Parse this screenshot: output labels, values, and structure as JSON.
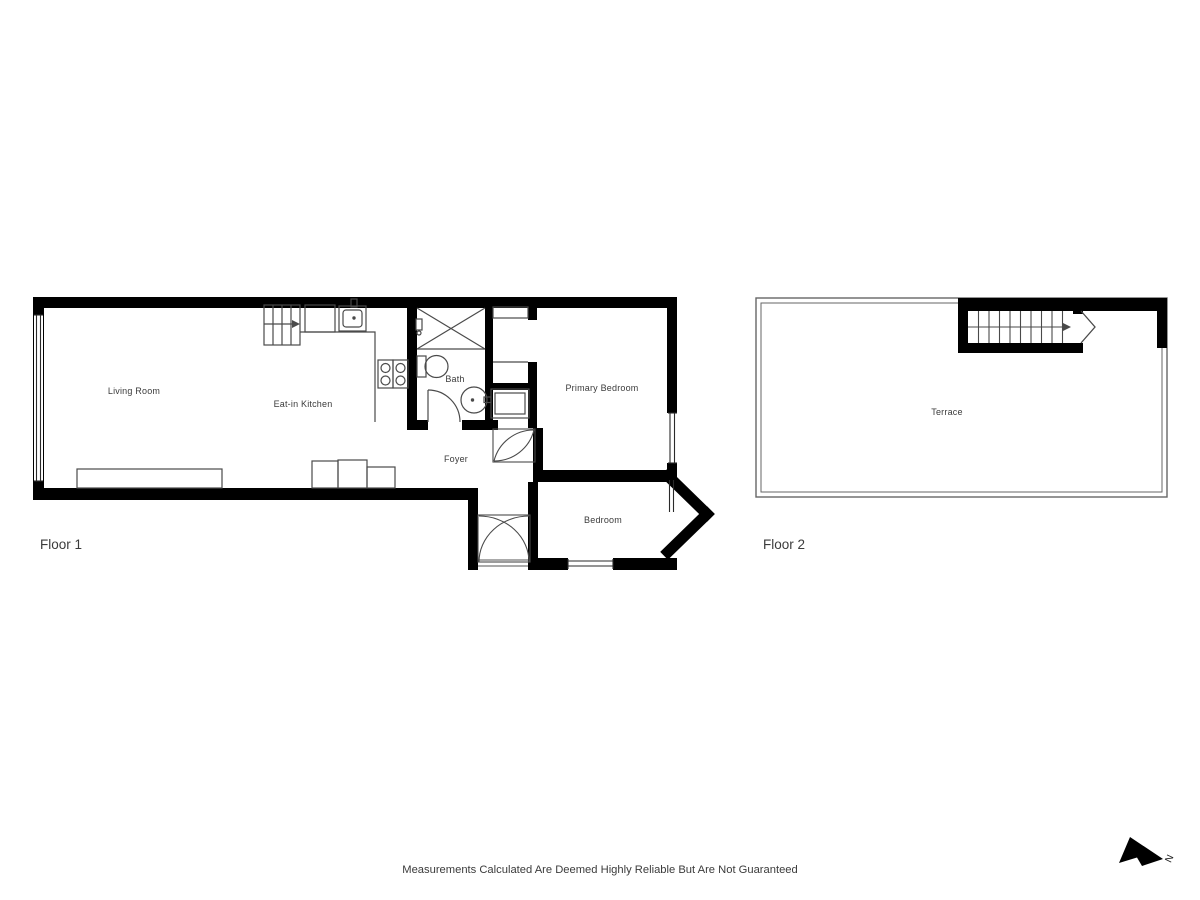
{
  "disclaimer": "Measurements Calculated Are Deemed Highly Reliable But Are Not Guaranteed",
  "compass": {
    "label": "N"
  },
  "colors": {
    "wall": "#000000",
    "fixture_line": "#4a4a4a",
    "window_line": "#2a2a2a",
    "text": "#3b3b3b"
  },
  "floor1": {
    "label": "Floor 1",
    "rooms": {
      "living_room": "Living Room",
      "kitchen": "Eat-in Kitchen",
      "bath": "Bath",
      "foyer": "Foyer",
      "primary_bedroom": "Primary Bedroom",
      "bedroom": "Bedroom"
    }
  },
  "floor2": {
    "label": "Floor 2",
    "rooms": {
      "terrace": "Terrace"
    }
  }
}
